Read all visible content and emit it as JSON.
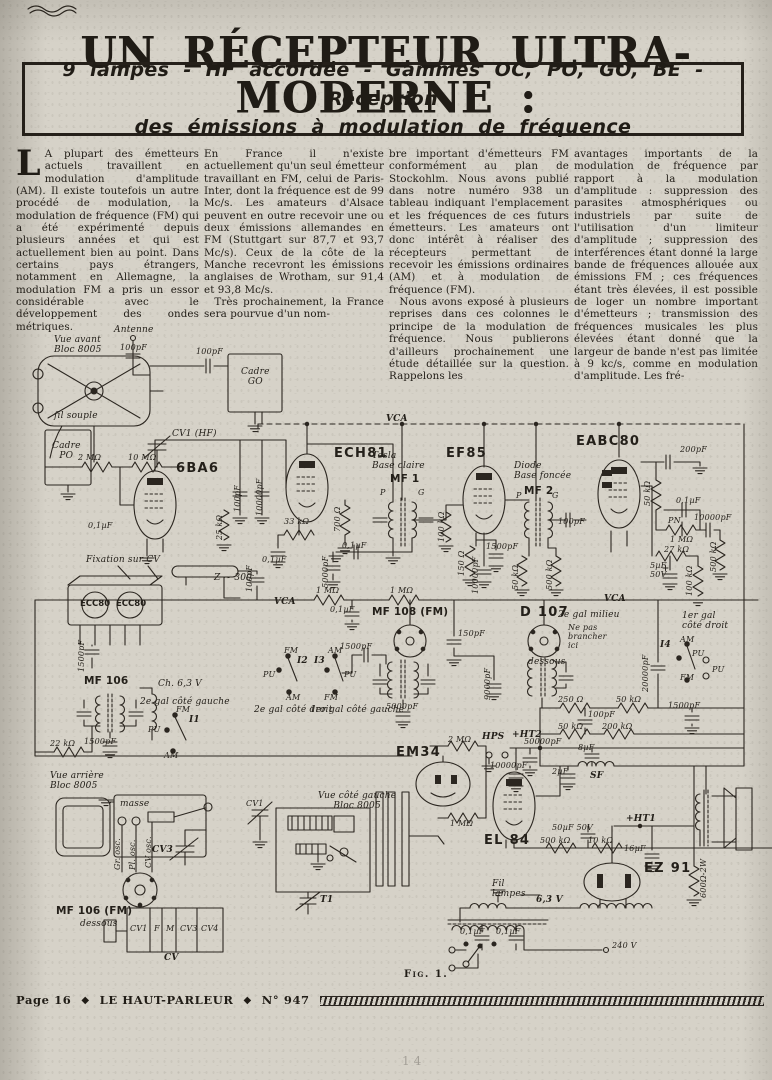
{
  "header": {
    "title": "UN RÉCEPTEUR ULTRA-MODERNE :",
    "subtitle_line1": "9 lampes  -  HF accordée  -  Gammes OC, PO, GO, BE  -  Réception",
    "subtitle_line2": "des émissions à modulation de fréquence"
  },
  "article": {
    "col1_dropcap": "L",
    "col1": "A plupart des émetteurs actuels travaillent en modulation d'amplitude (AM). Il existe toutefois un autre procédé de modulation, la modulation de fréquence (FM) qui a été expérimenté depuis plusieurs années et qui est actuellement bien au point. Dans certains pays étrangers, notamment en Allemagne, la modulation FM a pris un essor considérable avec le développement des ondes métriques.",
    "col2": "En France il n'existe actuellement qu'un seul émetteur travaillant en FM, celui de Paris-Inter, dont la fréquence est de 99 Mc/s. Les amateurs d'Alsace peuvent en outre recevoir une ou deux émissions allemandes en FM (Stuttgart sur 87,7 et 93,7 Mc/s). Ceux de la côte de la Manche recevront les émissions anglaises de Wrotham, sur 91,4 et 93,8 Mc/s.\n Très prochainement, la France sera pourvue d'un nom-",
    "col3": "bre important d'émetteurs FM conformément au plan de Stockohlm. Nous avons publié dans notre numéro 938 un tableau indiquant l'emplacement et les fréquences de ces futurs émetteurs. Les amateurs ont donc intérêt à réaliser des récepteurs permettant de recevoir les émissions ordinaires (AM) et à modulation de fréquence (FM).\n Nous avons exposé à plusieurs reprises dans ces colonnes le principe de la modulation de fréquence. Nous publierons d'ailleurs prochainement une étude détaillée sur la question. Rappelons les",
    "col4": "avantages importants de la modulation de fréquence par rapport à la modulation d'amplitude : suppression des parasites atmosphériques ou industriels par suite de l'utilisation d'un limiteur d'amplitude ; suppression des interférences étant donné la large bande de fréquences allouée aux émissions FM ; ces fréquences étant très élevées, il est possible de loger un nombre important d'émetteurs ; transmission des fréquences musicales les plus élevées étant donné que la largeur de bande n'est pas limitée à 9 kc/s, comme en modulation d'amplitude. Les fré-"
  },
  "figure": {
    "caption": "Fig. 1."
  },
  "footer": {
    "page": "Page 16",
    "diamond": "◆",
    "magazine": "LE HAUT-PARLEUR",
    "issue": "N° 947",
    "faint_page_number": "14"
  },
  "colors": {
    "paper": "#d6d2c8",
    "ink": "#25201a"
  },
  "schematic": {
    "labels": [
      {
        "n": "label-vue-avant",
        "t": "Vue avant\nBloc 8005",
        "x": 54,
        "y": 336,
        "c": "it"
      },
      {
        "n": "label-antenne",
        "t": "Antenne",
        "x": 114,
        "y": 326,
        "c": "it"
      },
      {
        "n": "value-ant-100pf",
        "t": "100pF",
        "x": 120,
        "y": 344,
        "c": "v"
      },
      {
        "n": "value-go-100pf",
        "t": "100pF",
        "x": 196,
        "y": 348,
        "c": "v"
      },
      {
        "n": "label-cadre-go",
        "t": "Cadre\nGO",
        "x": 241,
        "y": 368,
        "c": "it ctr"
      },
      {
        "n": "label-cadre-po",
        "t": "Cadre\nPO",
        "x": 52,
        "y": 442,
        "c": "it ctr"
      },
      {
        "n": "label-fil-souple",
        "t": "fil souple",
        "x": 54,
        "y": 412,
        "c": "it"
      },
      {
        "n": "label-cv1-hf",
        "t": "CV1 (HF)",
        "x": 172,
        "y": 430,
        "c": "it"
      },
      {
        "n": "value-r-2m",
        "t": "2 MΩ",
        "x": 78,
        "y": 454,
        "c": "v"
      },
      {
        "n": "value-r-10m",
        "t": "10 MΩ",
        "x": 128,
        "y": 454,
        "c": "v"
      },
      {
        "n": "label-6ba6",
        "t": "6BA6",
        "x": 176,
        "y": 462,
        "c": "tb"
      },
      {
        "n": "value-01-6ba6",
        "t": "0,1µF",
        "x": 88,
        "y": 522,
        "c": "v"
      },
      {
        "n": "value-100pf-a",
        "t": "100pF",
        "x": 234,
        "y": 512,
        "c": "v rot"
      },
      {
        "n": "value-10000pf-a",
        "t": "10000pF",
        "x": 256,
        "y": 516,
        "c": "v rot"
      },
      {
        "n": "value-25k",
        "t": "25 kΩ",
        "x": 216,
        "y": 540,
        "c": "v rot"
      },
      {
        "n": "label-vca-1",
        "t": "VCA",
        "x": 386,
        "y": 415,
        "c": "an"
      },
      {
        "n": "label-ech81",
        "t": "ECH81",
        "x": 334,
        "y": 447,
        "c": "tb"
      },
      {
        "n": "value-33k",
        "t": "33 kΩ",
        "x": 284,
        "y": 518,
        "c": "v"
      },
      {
        "n": "value-700",
        "t": "700 Ω",
        "x": 334,
        "y": 532,
        "c": "v rot"
      },
      {
        "n": "value-01-ech",
        "t": "0,1µF",
        "x": 262,
        "y": 556,
        "c": "v"
      },
      {
        "n": "value-5000-ech",
        "t": "5000pF",
        "x": 322,
        "y": 588,
        "c": "v rot"
      },
      {
        "n": "label-mf1-make",
        "t": "Tesla\nBase claire",
        "x": 372,
        "y": 452,
        "c": "it"
      },
      {
        "n": "label-mf1",
        "t": "MF 1",
        "x": 390,
        "y": 474,
        "c": "mf"
      },
      {
        "n": "label-mf1-p",
        "t": "P",
        "x": 380,
        "y": 489,
        "c": "v"
      },
      {
        "n": "label-mf1-g",
        "t": "G",
        "x": 418,
        "y": 489,
        "c": "v"
      },
      {
        "n": "value-100k-a",
        "t": "100 kΩ",
        "x": 438,
        "y": 542,
        "c": "v rot"
      },
      {
        "n": "value-01-mf1",
        "t": "0,1µF",
        "x": 342,
        "y": 542,
        "c": "v"
      },
      {
        "n": "label-ef85",
        "t": "EF85",
        "x": 446,
        "y": 447,
        "c": "tb"
      },
      {
        "n": "value-150",
        "t": "150 Ω",
        "x": 458,
        "y": 576,
        "c": "v rot"
      },
      {
        "n": "value-1500-ef",
        "t": "1500pF",
        "x": 486,
        "y": 543,
        "c": "v"
      },
      {
        "n": "value-10000-ef",
        "t": "10000pF",
        "x": 472,
        "y": 594,
        "c": "v rot"
      },
      {
        "n": "label-mf2-make",
        "t": "Diode\nBase foncée",
        "x": 514,
        "y": 462,
        "c": "it"
      },
      {
        "n": "label-mf2",
        "t": "MF 2",
        "x": 524,
        "y": 486,
        "c": "mf"
      },
      {
        "n": "label-mf2-p",
        "t": "P",
        "x": 516,
        "y": 492,
        "c": "v"
      },
      {
        "n": "label-mf2-g",
        "t": "G",
        "x": 552,
        "y": 492,
        "c": "v"
      },
      {
        "n": "value-100pf-mf2",
        "t": "100pF",
        "x": 558,
        "y": 518,
        "c": "v"
      },
      {
        "n": "value-50k-mf2",
        "t": "50 kΩ",
        "x": 512,
        "y": 590,
        "c": "v rot"
      },
      {
        "n": "value-500k-mf2",
        "t": "500 kΩ",
        "x": 546,
        "y": 590,
        "c": "v rot"
      },
      {
        "n": "label-eabc80",
        "t": "EABC80",
        "x": 576,
        "y": 435,
        "c": "tb"
      },
      {
        "n": "value-200pf",
        "t": "200pF",
        "x": 680,
        "y": 446,
        "c": "v"
      },
      {
        "n": "value-50k-eabc",
        "t": "50 kΩ",
        "x": 644,
        "y": 506,
        "c": "v rot"
      },
      {
        "n": "value-01-eabc",
        "t": "0,1µF",
        "x": 676,
        "y": 497,
        "c": "v"
      },
      {
        "n": "label-pn",
        "t": "PN",
        "x": 668,
        "y": 517,
        "c": "v"
      },
      {
        "n": "value-10000-eabc",
        "t": "10000pF",
        "x": 694,
        "y": 514,
        "c": "v"
      },
      {
        "n": "value-1m-eabc",
        "t": "1 MΩ",
        "x": 670,
        "y": 536,
        "c": "v"
      },
      {
        "n": "value-27k",
        "t": "27 kΩ",
        "x": 664,
        "y": 546,
        "c": "v"
      },
      {
        "n": "value-5uf",
        "t": "5µF\n50V",
        "x": 650,
        "y": 562,
        "c": "v"
      },
      {
        "n": "value-100k-eabc",
        "t": "100 kΩ",
        "x": 686,
        "y": 596,
        "c": "v rot"
      },
      {
        "n": "value-500k-eabc",
        "t": "500 kΩ",
        "x": 710,
        "y": 572,
        "c": "v rot"
      },
      {
        "n": "label-fixation",
        "t": "Fixation sur CV",
        "x": 86,
        "y": 556,
        "c": "it"
      },
      {
        "n": "label-ecc80-a",
        "t": "ECC80",
        "x": 80,
        "y": 600,
        "c": "tbs"
      },
      {
        "n": "label-ecc80-b",
        "t": "ECC80",
        "x": 116,
        "y": 600,
        "c": "tbs"
      },
      {
        "n": "label-z300",
        "t": "Z ~ 300",
        "x": 214,
        "y": 574,
        "c": "it"
      },
      {
        "n": "value-100pf-c",
        "t": "100pF",
        "x": 246,
        "y": 592,
        "c": "v rot"
      },
      {
        "n": "value-1500-ecc",
        "t": "1500pF",
        "x": 78,
        "y": 672,
        "c": "v rot"
      },
      {
        "n": "label-mf106",
        "t": "MF 106",
        "x": 84,
        "y": 676,
        "c": "mf"
      },
      {
        "n": "label-ch63",
        "t": "Ch. 6,3 V",
        "x": 158,
        "y": 680,
        "c": "it"
      },
      {
        "n": "value-1500-mf106",
        "t": "1500pF",
        "x": 84,
        "y": 738,
        "c": "v"
      },
      {
        "n": "value-22k",
        "t": "22 kΩ",
        "x": 50,
        "y": 740,
        "c": "v"
      },
      {
        "n": "label-gal-1",
        "t": "2e gal côté gauche",
        "x": 140,
        "y": 698,
        "c": "it"
      },
      {
        "n": "label-sw1-fm",
        "t": "FM",
        "x": 176,
        "y": 706,
        "c": "v"
      },
      {
        "n": "label-sw1-i",
        "t": "I1",
        "x": 189,
        "y": 716,
        "c": "an"
      },
      {
        "n": "label-sw1-pu",
        "t": "PU",
        "x": 148,
        "y": 726,
        "c": "v"
      },
      {
        "n": "label-sw1-am",
        "t": "AM",
        "x": 164,
        "y": 752,
        "c": "v"
      },
      {
        "n": "label-vca-2",
        "t": "VCA",
        "x": 274,
        "y": 598,
        "c": "an"
      },
      {
        "n": "value-1m-b1",
        "t": "1 MΩ",
        "x": 316,
        "y": 587,
        "c": "v"
      },
      {
        "n": "value-1m-b2",
        "t": "1 MΩ",
        "x": 390,
        "y": 587,
        "c": "v"
      },
      {
        "n": "value-01-bus",
        "t": "0,1µF",
        "x": 330,
        "y": 606,
        "c": "v"
      },
      {
        "n": "label-sw2-fm",
        "t": "FM",
        "x": 284,
        "y": 647,
        "c": "v"
      },
      {
        "n": "label-sw2-i",
        "t": "I2",
        "x": 297,
        "y": 657,
        "c": "an"
      },
      {
        "n": "label-sw2-pu",
        "t": "PU",
        "x": 263,
        "y": 671,
        "c": "v"
      },
      {
        "n": "label-sw2-am",
        "t": "AM",
        "x": 286,
        "y": 694,
        "c": "v"
      },
      {
        "n": "label-gal-2",
        "t": "2e gal côté droit",
        "x": 254,
        "y": 706,
        "c": "it"
      },
      {
        "n": "label-sw3-am",
        "t": "AM",
        "x": 328,
        "y": 647,
        "c": "v"
      },
      {
        "n": "label-sw3-i",
        "t": "I3",
        "x": 314,
        "y": 657,
        "c": "an"
      },
      {
        "n": "label-sw3-pu",
        "t": "PU",
        "x": 344,
        "y": 671,
        "c": "v"
      },
      {
        "n": "label-sw3-fm",
        "t": "FM",
        "x": 324,
        "y": 694,
        "c": "v"
      },
      {
        "n": "label-gal-3",
        "t": "1er gal côté gauche",
        "x": 310,
        "y": 706,
        "c": "it"
      },
      {
        "n": "value-1500-sw",
        "t": "1500pF",
        "x": 340,
        "y": 643,
        "c": "v"
      },
      {
        "n": "label-mf108",
        "t": "MF 108 (FM)",
        "x": 372,
        "y": 607,
        "c": "mf"
      },
      {
        "n": "value-5000-mf108",
        "t": "5000pF",
        "x": 386,
        "y": 703,
        "c": "v"
      },
      {
        "n": "value-150pf",
        "t": "150pF",
        "x": 458,
        "y": 630,
        "c": "v"
      },
      {
        "n": "value-9000",
        "t": "9000pF",
        "x": 484,
        "y": 700,
        "c": "v rot"
      },
      {
        "n": "label-d107",
        "t": "D 107",
        "x": 520,
        "y": 606,
        "c": "tb"
      },
      {
        "n": "label-d107-note",
        "t": "2e gal milieu",
        "x": 558,
        "y": 611,
        "c": "it"
      },
      {
        "n": "label-d107-warn",
        "t": "Ne pas\nbrancher\nici",
        "x": 568,
        "y": 624,
        "c": "v"
      },
      {
        "n": "label-d107-dessous",
        "t": "dessous",
        "x": 528,
        "y": 658,
        "c": "it"
      },
      {
        "n": "label-vca-3",
        "t": "VCA",
        "x": 604,
        "y": 595,
        "c": "an"
      },
      {
        "n": "value-20000",
        "t": "20000pF",
        "x": 642,
        "y": 692,
        "c": "v rot"
      },
      {
        "n": "label-gal-4",
        "t": "1er gal\ncôté droit",
        "x": 682,
        "y": 612,
        "c": "it"
      },
      {
        "n": "label-sw4-am",
        "t": "AM",
        "x": 680,
        "y": 636,
        "c": "v"
      },
      {
        "n": "label-sw4-i",
        "t": "I4",
        "x": 660,
        "y": 641,
        "c": "an"
      },
      {
        "n": "label-sw4-pu",
        "t": "PU",
        "x": 692,
        "y": 650,
        "c": "v"
      },
      {
        "n": "label-sw4-fm",
        "t": "FM",
        "x": 680,
        "y": 674,
        "c": "v"
      },
      {
        "n": "label-pu-jacks",
        "t": "PU",
        "x": 712,
        "y": 666,
        "c": "v"
      },
      {
        "n": "value-250",
        "t": "250 Ω",
        "x": 558,
        "y": 696,
        "c": "v"
      },
      {
        "n": "value-50k-a",
        "t": "50 kΩ",
        "x": 616,
        "y": 696,
        "c": "v"
      },
      {
        "n": "value-100pf-b",
        "t": "100pF",
        "x": 588,
        "y": 711,
        "c": "v"
      },
      {
        "n": "value-50k-b",
        "t": "50 kΩ",
        "x": 558,
        "y": 723,
        "c": "v"
      },
      {
        "n": "value-200k",
        "t": "200 kΩ",
        "x": 602,
        "y": 723,
        "c": "v"
      },
      {
        "n": "value-1500-pu",
        "t": "1500pF",
        "x": 668,
        "y": 702,
        "c": "v"
      },
      {
        "n": "label-em34",
        "t": "EM34",
        "x": 396,
        "y": 746,
        "c": "tb"
      },
      {
        "n": "value-2m-em",
        "t": "2 MΩ",
        "x": 448,
        "y": 736,
        "c": "v"
      },
      {
        "n": "value-1m-em",
        "t": "1 MΩ",
        "x": 450,
        "y": 820,
        "c": "v"
      },
      {
        "n": "label-hps",
        "t": "HPS",
        "x": 482,
        "y": 733,
        "c": "an"
      },
      {
        "n": "label-ht2",
        "t": "+HT2",
        "x": 512,
        "y": 731,
        "c": "an"
      },
      {
        "n": "value-50000",
        "t": "50000pF",
        "x": 524,
        "y": 738,
        "c": "v"
      },
      {
        "n": "value-10000-ht2",
        "t": "10000pF",
        "x": 490,
        "y": 762,
        "c": "v"
      },
      {
        "n": "value-8uf",
        "t": "8µF",
        "x": 578,
        "y": 744,
        "c": "v"
      },
      {
        "n": "value-2uf",
        "t": "2µF",
        "x": 552,
        "y": 768,
        "c": "v"
      },
      {
        "n": "label-sf",
        "t": "SF",
        "x": 590,
        "y": 772,
        "c": "an"
      },
      {
        "n": "label-el84",
        "t": "EL 84",
        "x": 484,
        "y": 834,
        "c": "tb"
      },
      {
        "n": "value-50uf",
        "t": "50µF 50V",
        "x": 552,
        "y": 824,
        "c": "v"
      },
      {
        "n": "value-500k-b",
        "t": "500 kΩ",
        "x": 540,
        "y": 837,
        "c": "v"
      },
      {
        "n": "value-10k",
        "t": "10 kΩ",
        "x": 588,
        "y": 837,
        "c": "v"
      },
      {
        "n": "label-ht1",
        "t": "+HT1",
        "x": 626,
        "y": 815,
        "c": "an"
      },
      {
        "n": "value-16uf",
        "t": "16µF",
        "x": 624,
        "y": 845,
        "c": "v"
      },
      {
        "n": "label-ez91",
        "t": "EZ 91",
        "x": 644,
        "y": 862,
        "c": "tb"
      },
      {
        "n": "value-600",
        "t": "600Ω-2W",
        "x": 700,
        "y": 898,
        "c": "v rot"
      },
      {
        "n": "label-63v",
        "t": "6,3 V",
        "x": 536,
        "y": 896,
        "c": "an"
      },
      {
        "n": "label-fil-lampes",
        "t": "Fil\nlampes",
        "x": 492,
        "y": 880,
        "c": "it"
      },
      {
        "n": "value-01-tr1",
        "t": "0,1µF",
        "x": 460,
        "y": 928,
        "c": "v"
      },
      {
        "n": "value-01-tr2",
        "t": "0,1µF",
        "x": 496,
        "y": 928,
        "c": "v"
      },
      {
        "n": "value-240v",
        "t": "240 V",
        "x": 612,
        "y": 942,
        "c": "v"
      },
      {
        "n": "label-vue-arriere",
        "t": "Vue arrière\nBloc 8005",
        "x": 50,
        "y": 772,
        "c": "it"
      },
      {
        "n": "label-masse",
        "t": "masse",
        "x": 120,
        "y": 800,
        "c": "v it"
      },
      {
        "n": "label-cv3",
        "t": "CV3",
        "x": 152,
        "y": 846,
        "c": "an"
      },
      {
        "n": "label-gr-osc",
        "t": "Gr. osc.",
        "x": 114,
        "y": 870,
        "c": "v rot"
      },
      {
        "n": "label-pl-osc",
        "t": "Pl. osc.",
        "x": 129,
        "y": 870,
        "c": "v rot"
      },
      {
        "n": "label-cv-osc",
        "t": "CV osc.",
        "x": 145,
        "y": 868,
        "c": "v rot"
      },
      {
        "n": "label-mf106fm",
        "t": "MF 106 (FM)",
        "x": 56,
        "y": 906,
        "c": "mf"
      },
      {
        "n": "label-mf106fm-dessous",
        "t": "dessous",
        "x": 80,
        "y": 920,
        "c": "it"
      },
      {
        "n": "label-cv-cell-1",
        "t": "CV1",
        "x": 130,
        "y": 925,
        "c": "v"
      },
      {
        "n": "label-cv-cell-2",
        "t": "F",
        "x": 154,
        "y": 925,
        "c": "v"
      },
      {
        "n": "label-cv-cell-3",
        "t": "M",
        "x": 166,
        "y": 925,
        "c": "v"
      },
      {
        "n": "label-cv-cell-4",
        "t": "CV3",
        "x": 180,
        "y": 925,
        "c": "v"
      },
      {
        "n": "label-cv-cell-5",
        "t": "CV4",
        "x": 201,
        "y": 925,
        "c": "v"
      },
      {
        "n": "label-cv",
        "t": "CV",
        "x": 164,
        "y": 954,
        "c": "an"
      },
      {
        "n": "label-vue-gauche",
        "t": "Vue côté gauche\nBloc 8005",
        "x": 318,
        "y": 792,
        "c": "it ctr"
      },
      {
        "n": "label-cv1-side",
        "t": "CV1",
        "x": 246,
        "y": 800,
        "c": "v"
      },
      {
        "n": "label-t1",
        "t": "T1",
        "x": 320,
        "y": 896,
        "c": "an"
      }
    ]
  }
}
